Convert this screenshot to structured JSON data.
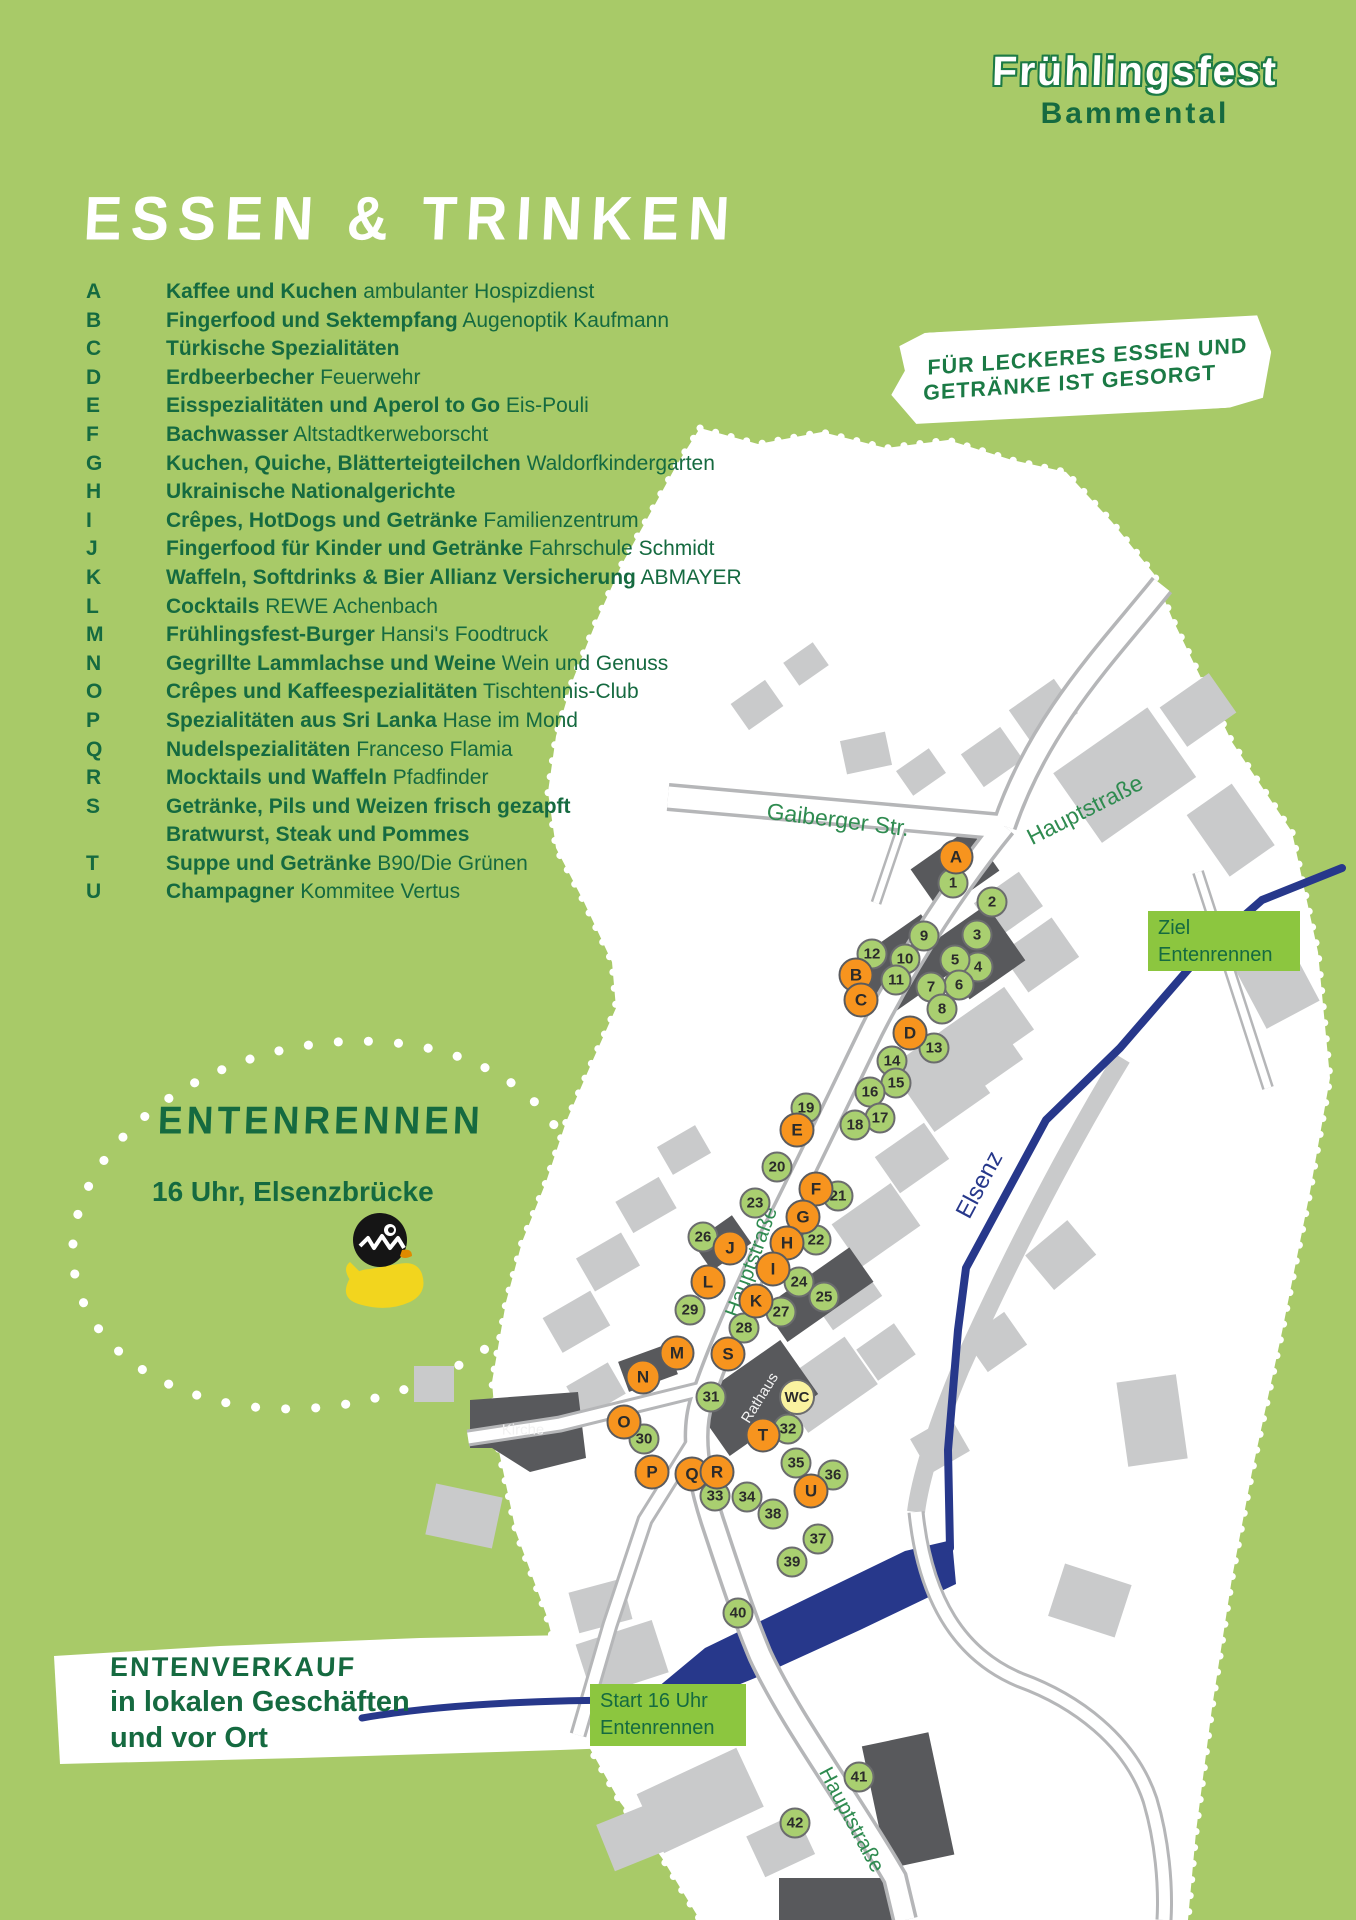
{
  "poster": {
    "logo": {
      "line1": "Frühlingsfest",
      "line2": "Bammental"
    },
    "title": "ESSEN & TRINKEN",
    "bubble": {
      "line1": "FÜR LECKERES ESSEN UND",
      "line2": "GETRÄNKE IST GESORGT"
    },
    "legend": [
      {
        "letter": "A",
        "bold": "Kaffee und Kuchen",
        "rest": "ambulanter Hospizdienst"
      },
      {
        "letter": "B",
        "bold": "Fingerfood und Sektempfang",
        "rest": "Augenoptik Kaufmann"
      },
      {
        "letter": "C",
        "bold": "Türkische Spezialitäten",
        "rest": ""
      },
      {
        "letter": "D",
        "bold": "Erdbeerbecher",
        "rest": "Feuerwehr"
      },
      {
        "letter": "E",
        "bold": "Eisspezialitäten und Aperol to Go",
        "rest": "Eis-Pouli"
      },
      {
        "letter": "F",
        "bold": "Bachwasser",
        "rest": "Altstadtkerweborscht"
      },
      {
        "letter": "G",
        "bold": "Kuchen, Quiche, Blätterteigteilchen",
        "rest": "Waldorfkindergarten"
      },
      {
        "letter": "H",
        "bold": "Ukrainische Nationalgerichte",
        "rest": ""
      },
      {
        "letter": "I",
        "bold": "Crêpes, HotDogs und Getränke",
        "rest": "Familienzentrum"
      },
      {
        "letter": "J",
        "bold": "Fingerfood für Kinder und Getränke",
        "rest": "Fahrschule Schmidt"
      },
      {
        "letter": "K",
        "bold": "Waffeln, Softdrinks & Bier Allianz Versicherung",
        "rest": "ABMAYER"
      },
      {
        "letter": "L",
        "bold": "Cocktails",
        "rest": "REWE Achenbach"
      },
      {
        "letter": "M",
        "bold": "Frühlingsfest-Burger",
        "rest": "Hansi's Foodtruck"
      },
      {
        "letter": "N",
        "bold": "Gegrillte Lammlachse und Weine",
        "rest": "Wein und Genuss"
      },
      {
        "letter": "O",
        "bold": "Crêpes und Kaffeespezialitäten",
        "rest": "Tischtennis-Club"
      },
      {
        "letter": "P",
        "bold": "Spezialitäten aus Sri Lanka",
        "rest": "Hase im Mond"
      },
      {
        "letter": "Q",
        "bold": "Nudelspezialitäten",
        "rest": "Franceso Flamia"
      },
      {
        "letter": "R",
        "bold": "Mocktails und Waffeln",
        "rest": "Pfadfinder"
      },
      {
        "letter": "S",
        "bold": "Getränke, Pils und Weizen frisch gezapft",
        "rest": "",
        "bold2": "Bratwurst, Steak und Pommes"
      },
      {
        "letter": "T",
        "bold": "Suppe und Getränke",
        "rest": "B90/Die Grünen"
      },
      {
        "letter": "U",
        "bold": "Champagner",
        "rest": "Kommitee Vertus"
      }
    ],
    "duck_race": {
      "heading": "ENTENRENNEN",
      "subheading": "16 Uhr, Elsenzbrücke"
    },
    "duck_sale": {
      "heading": "ENTENVERKAUF",
      "line1": "in lokalen Geschäften",
      "line2": "und vor Ort"
    }
  },
  "map": {
    "boxes": {
      "ziel": {
        "line1": "Ziel",
        "line2": "Entenrennen"
      },
      "start": {
        "line1": "Start 16 Uhr",
        "line2": "Entenrennen"
      }
    },
    "street_labels": [
      {
        "text": "Gaiberger Str.",
        "x": 838,
        "y": 820,
        "rot": 7,
        "size": 23,
        "cls": ""
      },
      {
        "text": "Hauptstraße",
        "x": 1085,
        "y": 810,
        "rot": -27,
        "size": 23,
        "cls": ""
      },
      {
        "text": "Hauptstraße",
        "x": 752,
        "y": 1262,
        "rot": -70,
        "size": 21,
        "cls": ""
      },
      {
        "text": "Hauptstraße",
        "x": 851,
        "y": 1820,
        "rot": 62,
        "size": 21,
        "cls": ""
      },
      {
        "text": "Elsenz",
        "x": 980,
        "y": 1185,
        "rot": -62,
        "size": 24,
        "cls": "river"
      },
      {
        "text": "Rathaus",
        "x": 760,
        "y": 1398,
        "rot": -58,
        "size": 15,
        "cls": "bldg"
      },
      {
        "text": "Kirche",
        "x": 523,
        "y": 1430,
        "rot": 0,
        "size": 15,
        "cls": "bldg"
      }
    ],
    "stands": [
      {
        "id": "1",
        "type": "num",
        "x": 953,
        "y": 883
      },
      {
        "id": "2",
        "type": "num",
        "x": 992,
        "y": 902
      },
      {
        "id": "3",
        "type": "num",
        "x": 977,
        "y": 935
      },
      {
        "id": "4",
        "type": "num",
        "x": 978,
        "y": 967
      },
      {
        "id": "5",
        "type": "num",
        "x": 955,
        "y": 960
      },
      {
        "id": "6",
        "type": "num",
        "x": 959,
        "y": 985
      },
      {
        "id": "7",
        "type": "num",
        "x": 931,
        "y": 987
      },
      {
        "id": "8",
        "type": "num",
        "x": 942,
        "y": 1009
      },
      {
        "id": "9",
        "type": "num",
        "x": 924,
        "y": 936
      },
      {
        "id": "10",
        "type": "num",
        "x": 905,
        "y": 959
      },
      {
        "id": "11",
        "type": "num",
        "x": 896,
        "y": 980
      },
      {
        "id": "12",
        "type": "num",
        "x": 872,
        "y": 954
      },
      {
        "id": "13",
        "type": "num",
        "x": 934,
        "y": 1048
      },
      {
        "id": "14",
        "type": "num",
        "x": 892,
        "y": 1061
      },
      {
        "id": "15",
        "type": "num",
        "x": 896,
        "y": 1083
      },
      {
        "id": "16",
        "type": "num",
        "x": 870,
        "y": 1092
      },
      {
        "id": "17",
        "type": "num",
        "x": 880,
        "y": 1118
      },
      {
        "id": "18",
        "type": "num",
        "x": 855,
        "y": 1125
      },
      {
        "id": "19",
        "type": "num",
        "x": 806,
        "y": 1108
      },
      {
        "id": "20",
        "type": "num",
        "x": 777,
        "y": 1167
      },
      {
        "id": "21",
        "type": "num",
        "x": 838,
        "y": 1196
      },
      {
        "id": "22",
        "type": "num",
        "x": 816,
        "y": 1240
      },
      {
        "id": "23",
        "type": "num",
        "x": 755,
        "y": 1203
      },
      {
        "id": "24",
        "type": "num",
        "x": 799,
        "y": 1282
      },
      {
        "id": "25",
        "type": "num",
        "x": 824,
        "y": 1297
      },
      {
        "id": "26",
        "type": "num",
        "x": 703,
        "y": 1237
      },
      {
        "id": "27",
        "type": "num",
        "x": 781,
        "y": 1312
      },
      {
        "id": "28",
        "type": "num",
        "x": 744,
        "y": 1328
      },
      {
        "id": "29",
        "type": "num",
        "x": 690,
        "y": 1310
      },
      {
        "id": "30",
        "type": "num",
        "x": 644,
        "y": 1439
      },
      {
        "id": "31",
        "type": "num",
        "x": 711,
        "y": 1397
      },
      {
        "id": "32",
        "type": "num",
        "x": 788,
        "y": 1429
      },
      {
        "id": "33",
        "type": "num",
        "x": 715,
        "y": 1496
      },
      {
        "id": "34",
        "type": "num",
        "x": 747,
        "y": 1497
      },
      {
        "id": "35",
        "type": "num",
        "x": 796,
        "y": 1463
      },
      {
        "id": "36",
        "type": "num",
        "x": 833,
        "y": 1475
      },
      {
        "id": "37",
        "type": "num",
        "x": 818,
        "y": 1539
      },
      {
        "id": "38",
        "type": "num",
        "x": 773,
        "y": 1514
      },
      {
        "id": "39",
        "type": "num",
        "x": 792,
        "y": 1562
      },
      {
        "id": "40",
        "type": "num",
        "x": 738,
        "y": 1613
      },
      {
        "id": "41",
        "type": "num",
        "x": 859,
        "y": 1777
      },
      {
        "id": "42",
        "type": "num",
        "x": 795,
        "y": 1823
      },
      {
        "id": "A",
        "type": "food",
        "x": 956,
        "y": 857
      },
      {
        "id": "B",
        "type": "food",
        "x": 856,
        "y": 975
      },
      {
        "id": "C",
        "type": "food",
        "x": 861,
        "y": 1000
      },
      {
        "id": "D",
        "type": "food",
        "x": 910,
        "y": 1033
      },
      {
        "id": "E",
        "type": "food",
        "x": 797,
        "y": 1130
      },
      {
        "id": "F",
        "type": "food",
        "x": 816,
        "y": 1189
      },
      {
        "id": "G",
        "type": "food",
        "x": 803,
        "y": 1217
      },
      {
        "id": "H",
        "type": "food",
        "x": 787,
        "y": 1243
      },
      {
        "id": "I",
        "type": "food",
        "x": 773,
        "y": 1269
      },
      {
        "id": "J",
        "type": "food",
        "x": 730,
        "y": 1248
      },
      {
        "id": "K",
        "type": "food",
        "x": 756,
        "y": 1301
      },
      {
        "id": "L",
        "type": "food",
        "x": 708,
        "y": 1282
      },
      {
        "id": "M",
        "type": "food",
        "x": 677,
        "y": 1353
      },
      {
        "id": "N",
        "type": "food",
        "x": 643,
        "y": 1377
      },
      {
        "id": "O",
        "type": "food",
        "x": 624,
        "y": 1422
      },
      {
        "id": "P",
        "type": "food",
        "x": 652,
        "y": 1472
      },
      {
        "id": "Q",
        "type": "food",
        "x": 692,
        "y": 1474
      },
      {
        "id": "R",
        "type": "food",
        "x": 717,
        "y": 1472
      },
      {
        "id": "S",
        "type": "food",
        "x": 728,
        "y": 1354
      },
      {
        "id": "T",
        "type": "food",
        "x": 763,
        "y": 1435
      },
      {
        "id": "U",
        "type": "food",
        "x": 811,
        "y": 1491
      },
      {
        "id": "WC",
        "type": "wc",
        "x": 797,
        "y": 1397
      }
    ]
  },
  "colors": {
    "background_green": "#a8ca68",
    "dark_green_text": "#156a40",
    "street_label_green": "#2f8b50",
    "label_box_green": "#8cc63f",
    "stand_orange": "#f7941e",
    "stand_green": "#a9cf70",
    "wc_yellow": "#faf3a0",
    "river_navy": "#27388b",
    "building_gray": "#c9cacb",
    "building_dark": "#58595c",
    "street_casing_gray": "#b5b6b8",
    "map_white": "#ffffff"
  }
}
